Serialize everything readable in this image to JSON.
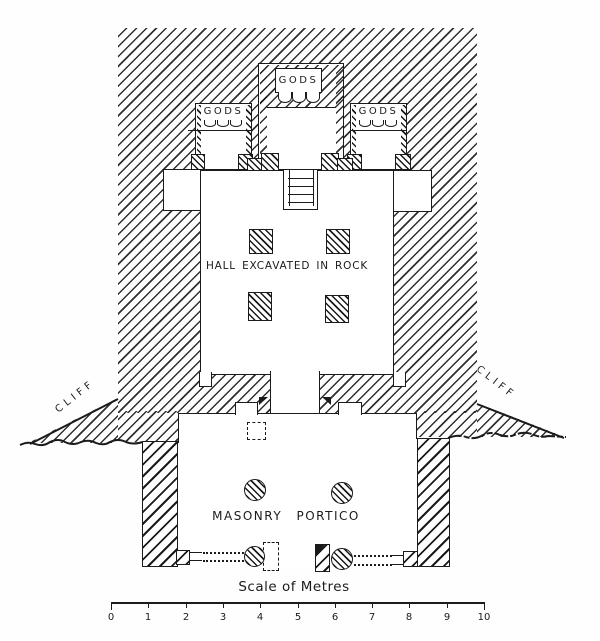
{
  "plan": {
    "shrines": {
      "left": "GODS",
      "center": "GODS",
      "right": "GODS"
    },
    "hall_label": "HALL EXCAVATED IN ROCK",
    "portico_label": "MASONRY PORTICO",
    "cliff_left": "CLIFF",
    "cliff_right": "CLIFF"
  },
  "scale_bar": {
    "title": "Scale of Metres",
    "ticks": [
      "0",
      "1",
      "2",
      "3",
      "4",
      "5",
      "6",
      "7",
      "8",
      "9",
      "10"
    ]
  },
  "colors": {
    "ink": "#1b1b1b",
    "paper": "#ffffff"
  }
}
